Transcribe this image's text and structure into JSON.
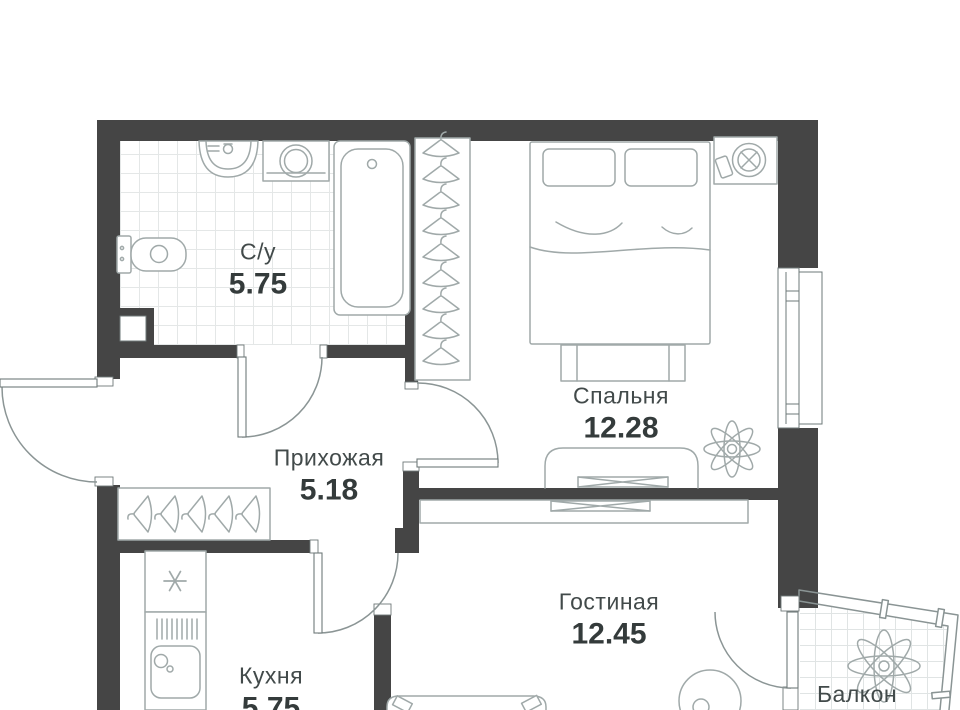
{
  "plan": {
    "title": "Apartment floor plan",
    "rooms": [
      {
        "id": "bathroom",
        "name": "С/у",
        "area": "5.75"
      },
      {
        "id": "bedroom",
        "name": "Спальня",
        "area": "12.28"
      },
      {
        "id": "hallway",
        "name": "Прихожая",
        "area": "5.18"
      },
      {
        "id": "kitchen",
        "name": "Кухня",
        "area": "5.75"
      },
      {
        "id": "living",
        "name": "Гостиная",
        "area": "12.45"
      },
      {
        "id": "balcony",
        "name": "Балкон",
        "area": ""
      }
    ],
    "colors": {
      "wall": "#454545",
      "furniture_line": "#a0a9a9",
      "door_line": "#8b9595",
      "tile_line": "#e4e7e7",
      "text": "#3d4444"
    },
    "symbols": [
      "toilet",
      "sink",
      "washing-machine",
      "bathtub",
      "exhaust-shaft",
      "wardrobe-hangers",
      "double-bed",
      "bed-bench",
      "nightstand-fan",
      "phone",
      "tv-console",
      "tv",
      "plant",
      "closet-hangers",
      "fridge-snowflake",
      "kitchen-sink",
      "sofa",
      "armchair",
      "door-swing",
      "window",
      "balcony-glazing"
    ]
  }
}
